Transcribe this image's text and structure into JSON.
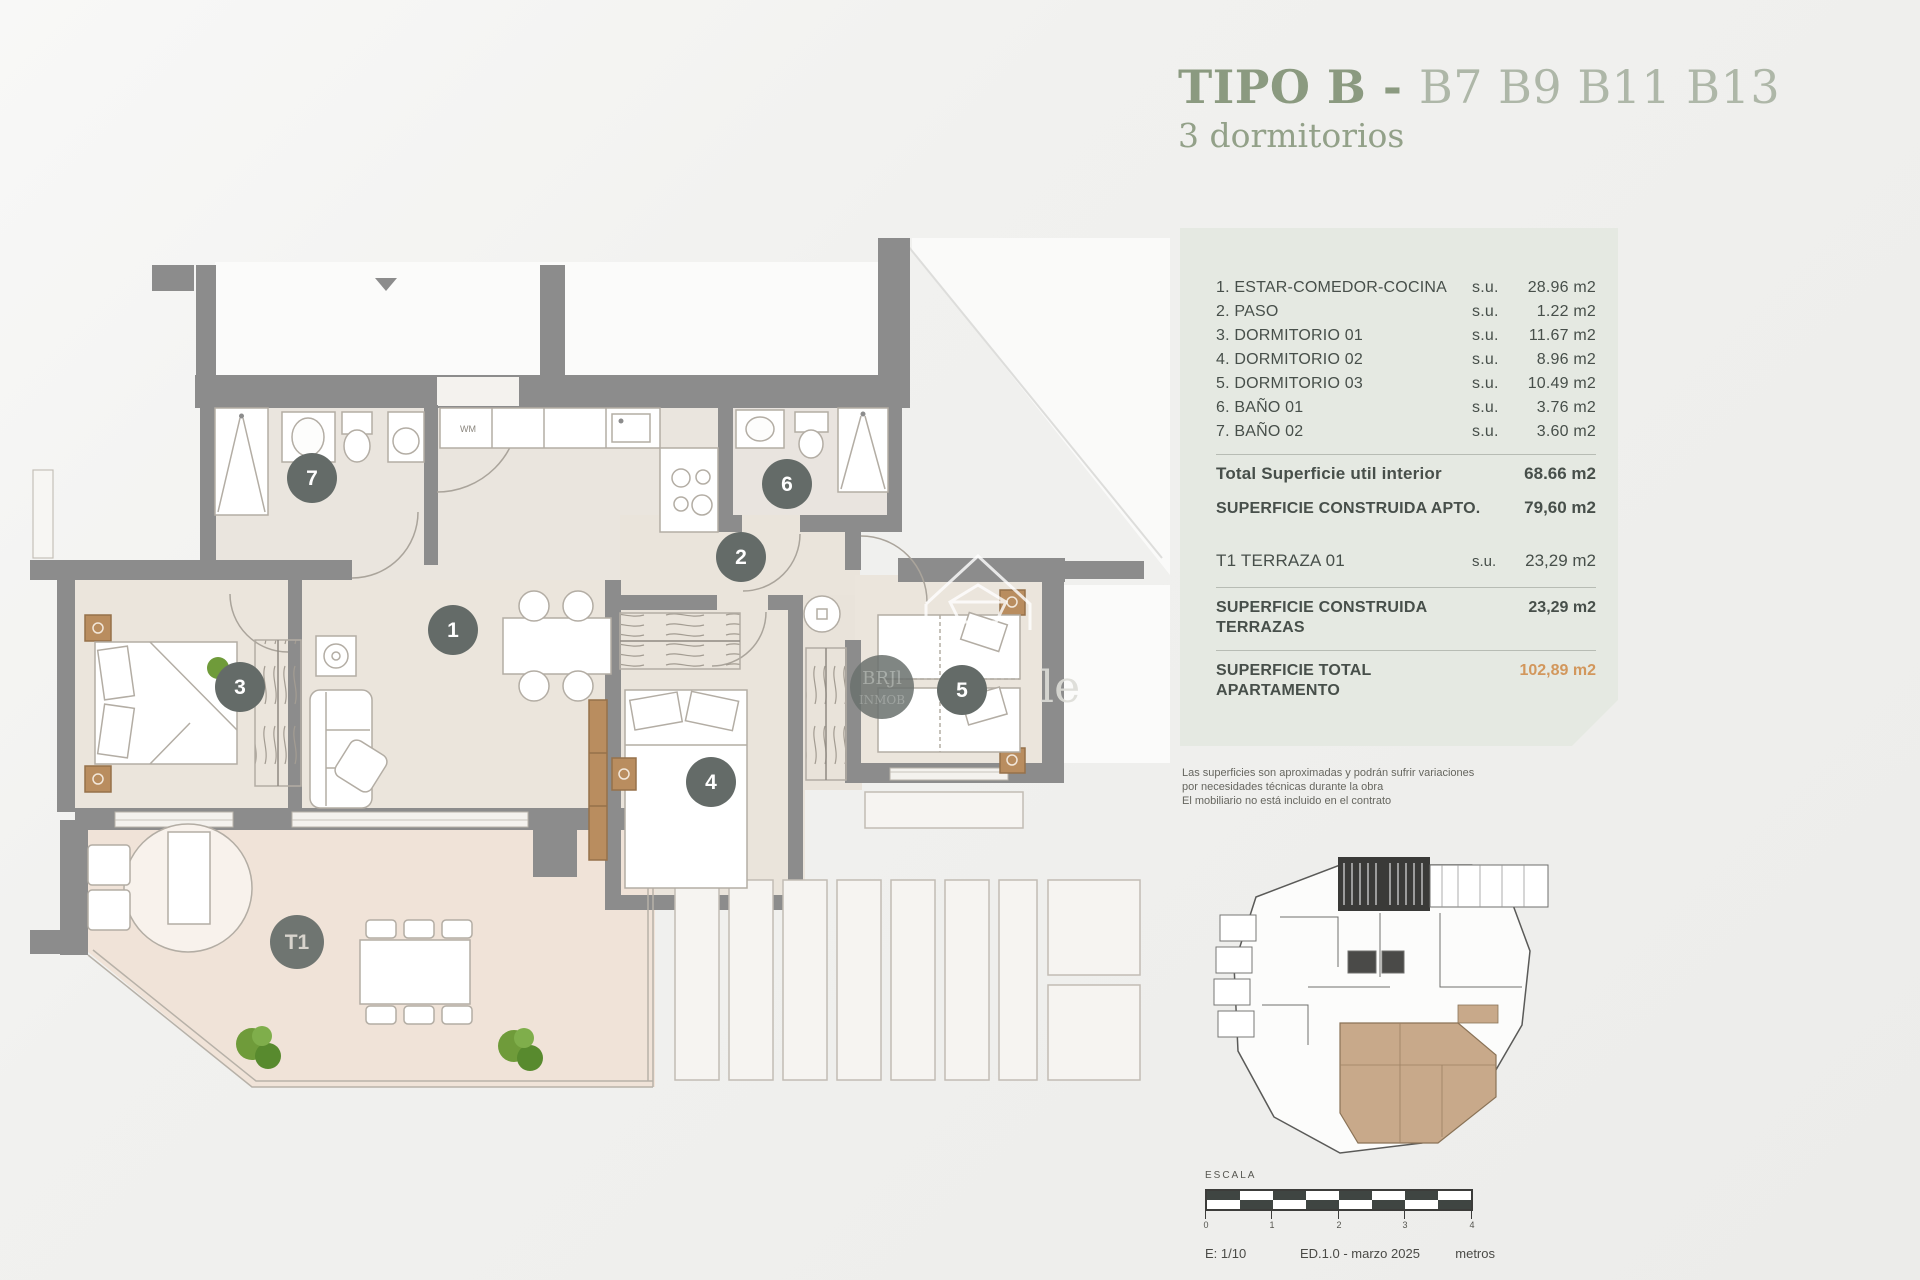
{
  "header": {
    "title_strong": "TIPO B",
    "title_sep": " - ",
    "title_units": "B7 B9 B11 B13",
    "subtitle": "3 dormitorios"
  },
  "panel": {
    "rooms": [
      {
        "label": "1. ESTAR-COMEDOR-COCINA",
        "prefix": "s.u.",
        "value": "28.96 m2"
      },
      {
        "label": "2. PASO",
        "prefix": "s.u.",
        "value": "1.22 m2"
      },
      {
        "label": "3. DORMITORIO 01",
        "prefix": "s.u.",
        "value": "11.67 m2"
      },
      {
        "label": "4. DORMITORIO 02",
        "prefix": "s.u.",
        "value": "8.96 m2"
      },
      {
        "label": "5. DORMITORIO 03",
        "prefix": "s.u.",
        "value": "10.49 m2"
      },
      {
        "label": "6. BAÑO 01",
        "prefix": "s.u.",
        "value": "3.76 m2"
      },
      {
        "label": "7. BAÑO 02",
        "prefix": "s.u.",
        "value": "3.60 m2"
      }
    ],
    "total_util": {
      "label": "Total Superficie util interior",
      "value": "68.66 m2"
    },
    "constructed_apto": {
      "label": "SUPERFICIE CONSTRUIDA APTO.",
      "value": "79,60 m2"
    },
    "terrace": {
      "label": "T1 TERRAZA 01",
      "prefix": "s.u.",
      "value": "23,29 m2"
    },
    "constructed_terr": {
      "label1": "SUPERFICIE CONSTRUIDA",
      "label2": "TERRAZAS",
      "value": "23,29 m2"
    },
    "grand_total": {
      "label1": "SUPERFICIE TOTAL",
      "label2": "APARTAMENTO",
      "value": "102,89 m2"
    }
  },
  "disclaimer": {
    "line1": "Las superficies son aproximadas y podrán sufrir variaciones",
    "line2": "por necesidades técnicas durante la obra",
    "line3": "El mobiliario no está incluido en el contrato"
  },
  "plan": {
    "labels": {
      "r1": "1",
      "r2": "2",
      "r3": "3",
      "r4": "4",
      "r5": "5",
      "r6": "6",
      "r7": "7",
      "t1": "T1"
    },
    "kitchen_appliance": "WM",
    "watermark": {
      "line1": "BRJl",
      "line2": "INMOB",
      "ghost": "le"
    }
  },
  "scalebar": {
    "title": "ESCALA",
    "ticks": {
      "t0": "0",
      "t1": "1",
      "t2": "2",
      "t3": "3",
      "t4": "4"
    },
    "scale": "E: 1/10",
    "edition": "ED.1.0 - marzo 2025",
    "units": "metros"
  },
  "colors": {
    "wall": "#8c8c8c",
    "floor": "#eae4dc",
    "terrace_floor": "#f0e3d8",
    "circle": "#646b68",
    "accent_green": "#8b9a80",
    "accent_orange": "#d2975c",
    "panel_bg": "#e5e9e2",
    "keyplan_unit": "#c8a98a"
  }
}
